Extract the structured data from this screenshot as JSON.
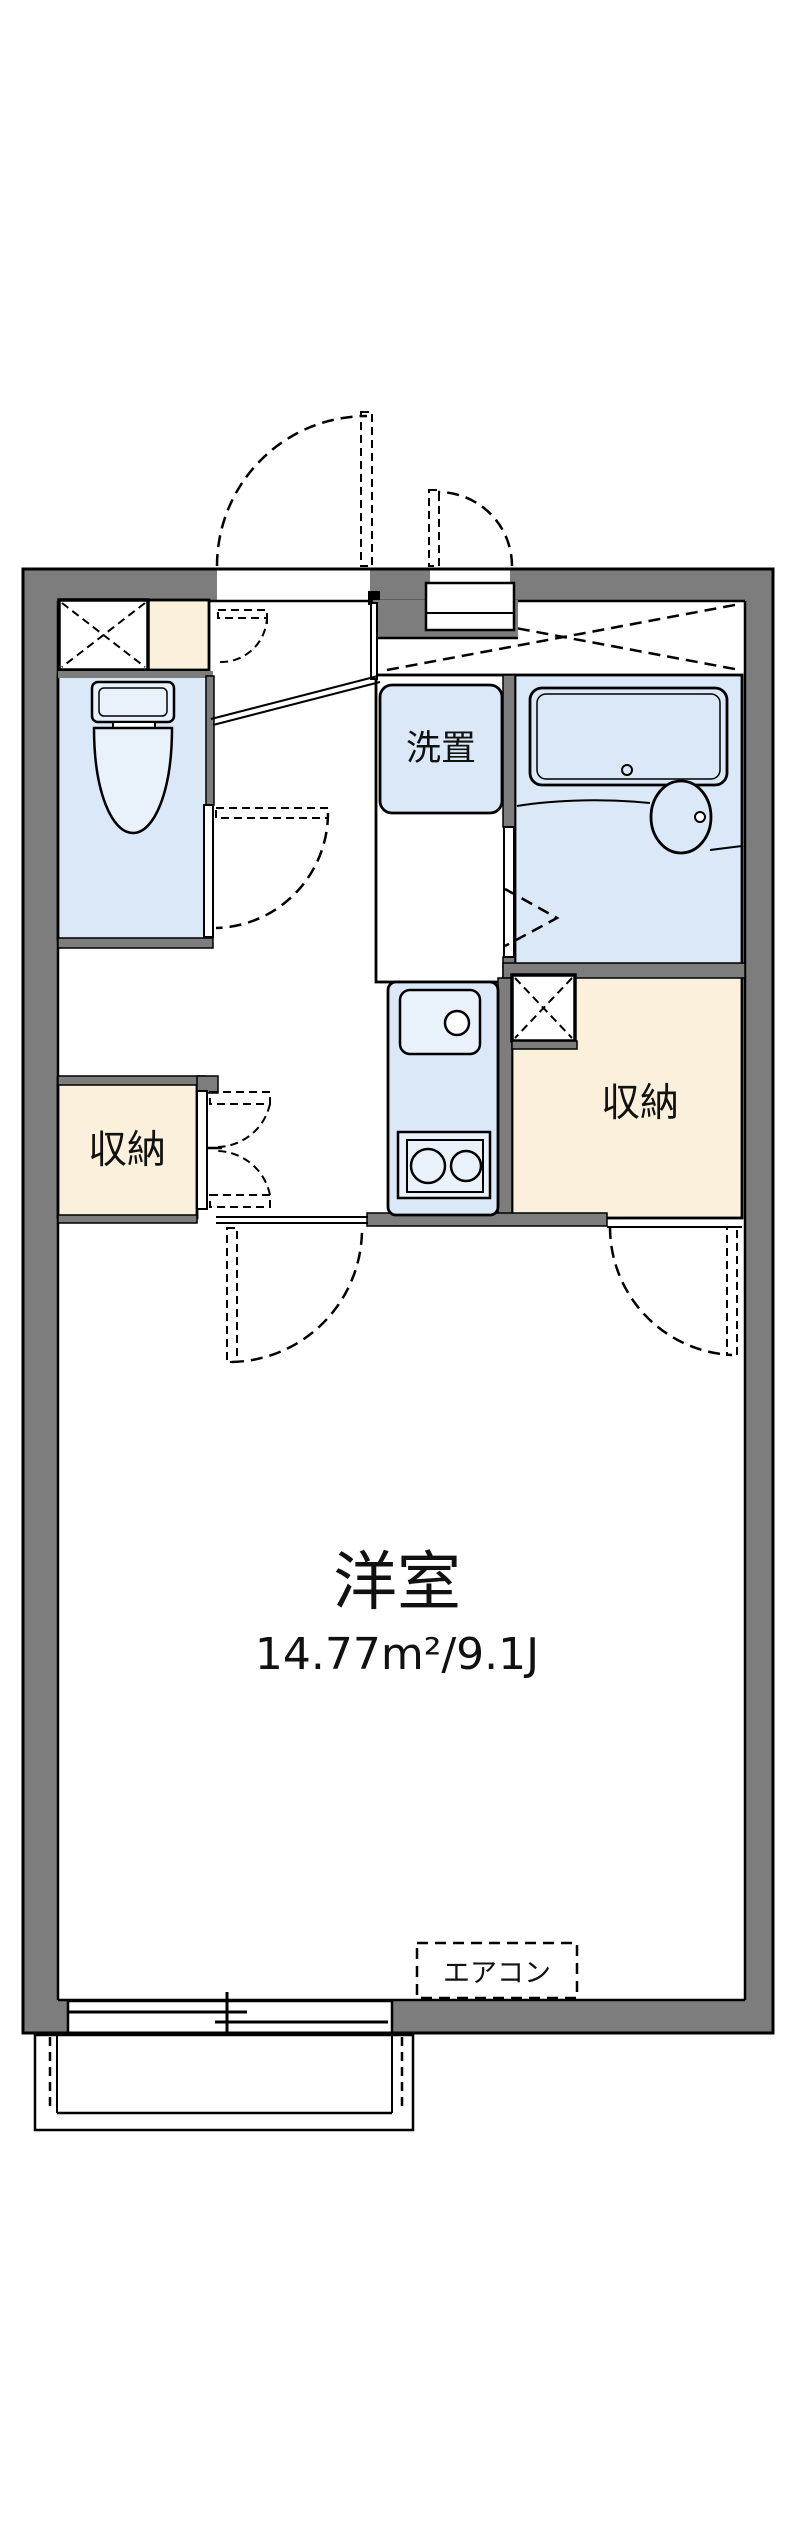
{
  "colors": {
    "wall_gray": "#7d7d7d",
    "room_blue": "#dbe8f8",
    "room_cream": "#faf0dc",
    "fixture_blue": "#e9f1fb",
    "line_black": "#000000"
  },
  "rooms": {
    "washer_space": {
      "label": "洗置"
    },
    "storage_left": {
      "label": "収納"
    },
    "storage_right": {
      "label": "収納"
    },
    "western_room": {
      "label": "洋室",
      "area": "14.77m²/9.1J"
    },
    "air_conditioner": {
      "label": "エアコン"
    }
  }
}
